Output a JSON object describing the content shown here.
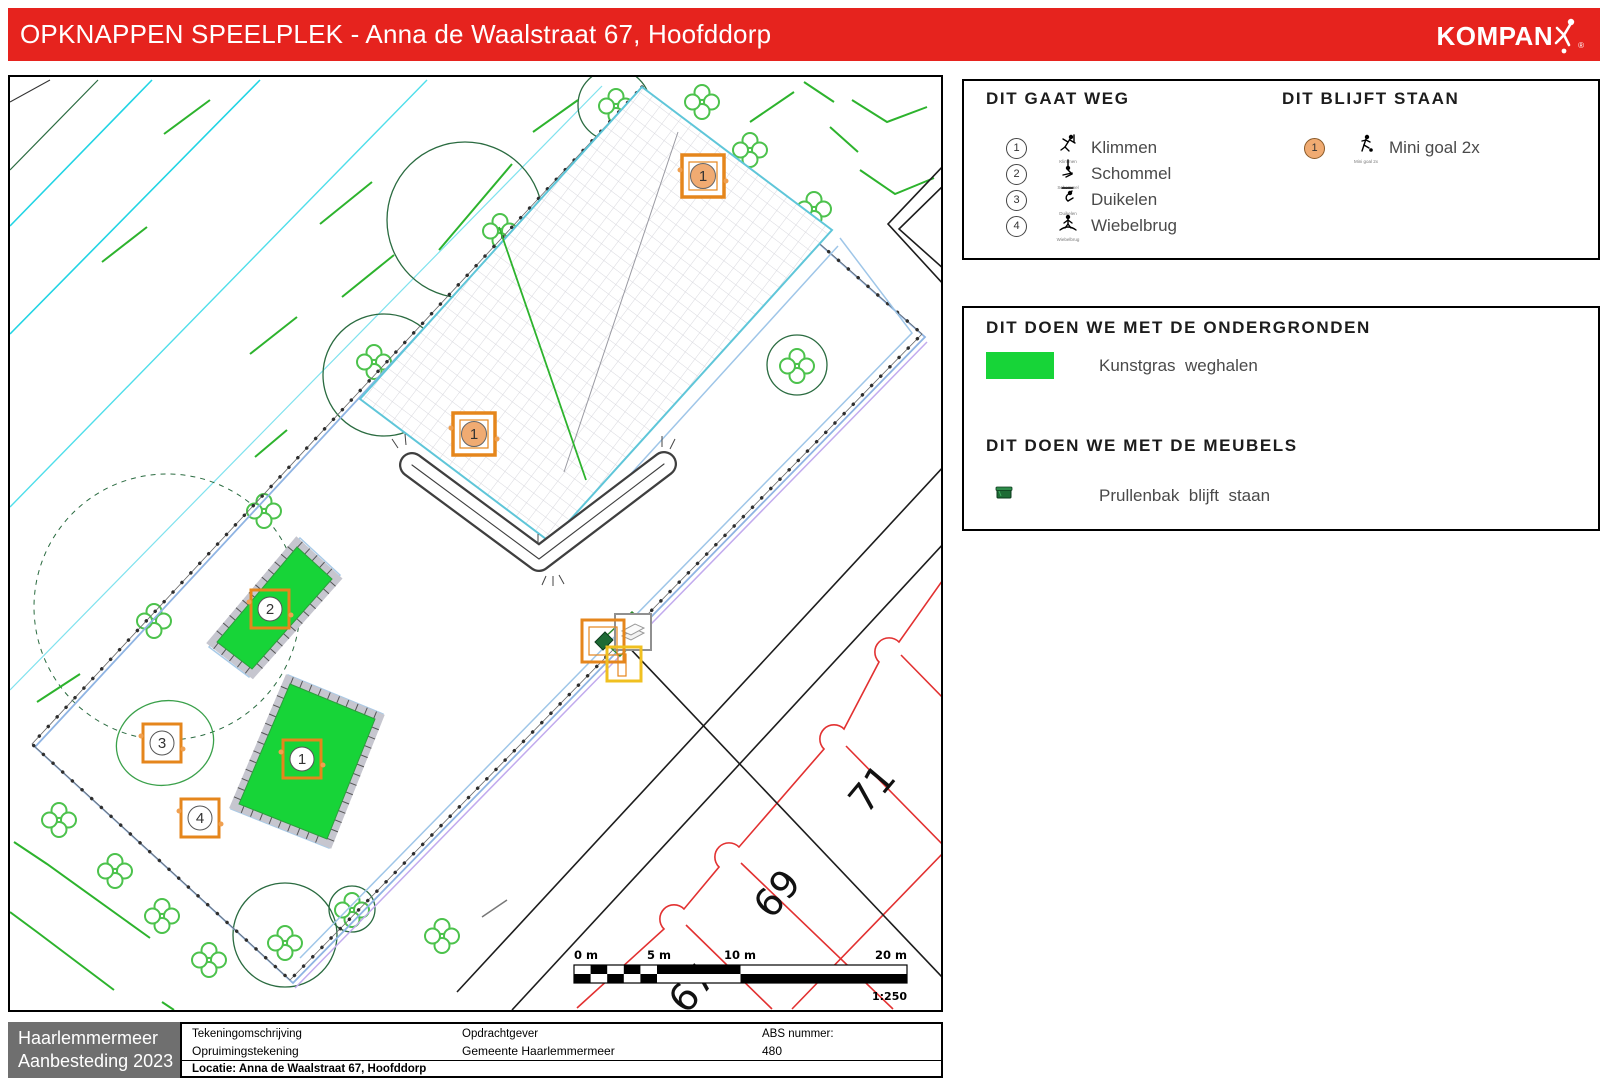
{
  "header": {
    "title": "OPKNAPPEN SPEELPLEK - Anna de Waalstraat 67, Hoofddorp",
    "brand": "KOMPAN",
    "brand_reg": "®",
    "bar_color": "#e6231e"
  },
  "legend_removed": {
    "title": "DIT GAAT WEG",
    "items": [
      {
        "num": "1",
        "label": "Klimmen",
        "icon": "climbing-figure-icon"
      },
      {
        "num": "2",
        "label": "Schommel",
        "icon": "swing-figure-icon"
      },
      {
        "num": "3",
        "label": "Duikelen",
        "icon": "somersault-figure-icon"
      },
      {
        "num": "4",
        "label": "Wiebelbrug",
        "icon": "wobble-bridge-figure-icon"
      }
    ]
  },
  "legend_kept": {
    "title": "DIT BLIJFT STAAN",
    "items": [
      {
        "num": "1",
        "label": "Mini goal 2x",
        "icon": "football-figure-icon"
      }
    ]
  },
  "surfaces": {
    "title": "DIT DOEN WE MET DE ONDERGRONDEN",
    "items": [
      {
        "label": "Kunstgras  weghalen",
        "swatch_color": "#17d438",
        "swatch_style": "background:#17d438"
      }
    ]
  },
  "furniture": {
    "title": "DIT DOEN WE MET DE MEUBELS",
    "items": [
      {
        "label": "Prullenbak  blijft  staan",
        "icon": "trash-bin-icon"
      }
    ]
  },
  "map": {
    "markers_removed": [
      "1",
      "2",
      "3",
      "4"
    ],
    "markers_kept": [
      "1",
      "1"
    ],
    "house_numbers": [
      "71",
      "69",
      "67"
    ],
    "scalebar": {
      "labels": [
        "0 m",
        "5 m",
        "10 m",
        "20 m"
      ],
      "ratio": "1:250"
    },
    "colors": {
      "kunstgras": "#17d438",
      "marker_orange": "#e5861c",
      "kept_circle_fill": "#f0ab72",
      "boundary_blue": "#8fb4e3",
      "boundary_purple": "#c2abee",
      "hatch_border_cyan": "#5fc6d9",
      "water_cyan": "#21d4e4",
      "houses_red": "#e23131",
      "greens_dark": "#2a6b40",
      "greens_light": "#4cc24c"
    }
  },
  "titleblock": {
    "org_line1": "Haarlemmermeer",
    "org_line2": "Aanbesteding 2023",
    "col1_label": "Tekeningomschrijving",
    "col1_value": "Opruimingstekening",
    "col1_extra": "Locatie: Anna de Waalstraat 67, Hoofddorp",
    "col2_label": "Opdrachtgever",
    "col2_value": "Gemeente Haarlemmermeer",
    "col3_label": "ABS nummer:",
    "col3_value": "480"
  }
}
